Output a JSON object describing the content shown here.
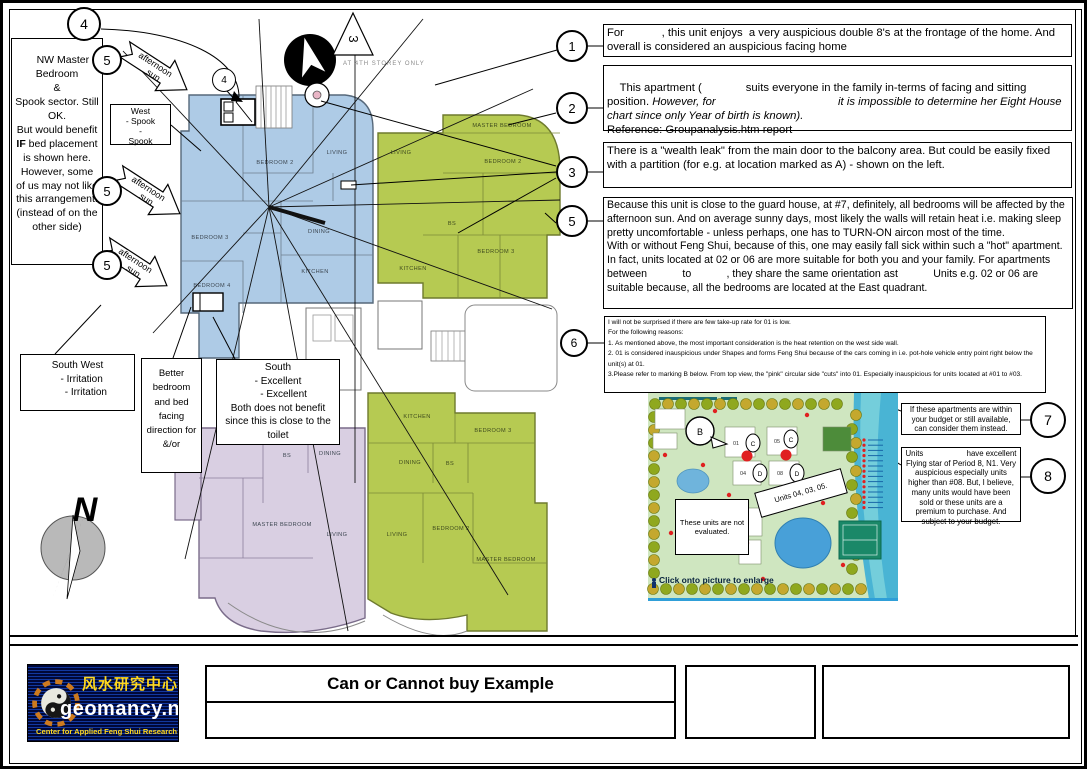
{
  "markers": {
    "n1": "1",
    "n2": "2",
    "n3": "3",
    "n4": "4",
    "n5": "5",
    "n6": "6",
    "n7": "7",
    "n8": "8"
  },
  "left": {
    "nw_part1": "NW Master Bedroom\n&\nSpook sector. Still OK.\nBut would benefit ",
    "nw_bold": "IF",
    "nw_part2": " bed placement is shown here. However, some of us may not like this arrangement.\n(instead of on the other side)",
    "west_box": "West\n- Spook\n-\nSpook",
    "sun_line1": "afternoon",
    "sun_line2": "sun",
    "southwest_box": "South West\n   - Irritation\n      - Irritation",
    "better_box": "Better bedroom and bed facing direction for &/or",
    "south_box": "South\n- Excellent\n    - Excellent\nBoth does not benefit since this is close to the toilet",
    "compass_n": "N"
  },
  "notes": {
    "note1": "For            , this unit enjoys  a very auspicious double 8's at the frontage of the home. And overall is considered an auspicious facing home",
    "note2_normal1": "This apartment (              suits everyone in the family in-terms of facing and sitting position. ",
    "note2_italic": "However, for                                       it is impossible to determine her Eight House chart since only Year of birth is known).",
    "note2_normal2": "\nReference: Groupanalysis.htm report",
    "note3": "There is a \"wealth leak\" from the main door to the balcony area. But could be easily fixed with a partition (for e.g. at location marked as A) - shown on the left.",
    "note4": "Because this unit is close to the guard house, at #7, definitely, all bedrooms will be affected by the afternoon sun. And on average sunny days, most likely the walls will retain heat i.e. making sleep pretty uncomfortable - unless perhaps, one has to TURN-ON aircon most of the time.\nWith or without Feng Shui, because of this, one may easily fall sick within such a \"hot\" apartment.\nIn fact, units located at 02 or 06 are more suitable for both you and your family. For apartments between            to            , they share the same orientation ast            Units e.g. 02 or 06 are suitable because, all the bedrooms are located at the East quadrant.",
    "note6": "I will not be surprised if there are few take-up rate for 01 is low.\nFor the following reasons:\n1. As mentioned above, the most important consideration is the heat retention on the west side wall.\n2. 01 is considered inauspicious under Shapes and forms Feng Shui because of the cars coming in i.e. pot-hole vehicle entry point right below the unit(s) at 01.\n3.Please refer to marking B below. From top view, the \"pink\" circular side \"cuts\" into 01. Especially inauspicious for units located at #01 to #03.",
    "note7": "If these apartments are within your budget or still available, can consider them instead.",
    "note8": "Units                    have excellent Flying star of Period 8, N1. Very auspicious especially units higher than #08. But, I believe, many units would have been sold or these units are a premium to purchase. And subject to your budget."
  },
  "plan": {
    "living": "LIVING",
    "dining": "DINING",
    "kitchen": "KITCHEN",
    "bedroom2": "BEDROOM 2",
    "bedroom3": "BEDROOM 3",
    "bedroom4": "BEDROOM 4",
    "master_bedroom": "MASTER BEDROOM",
    "bs": "BS",
    "storey_note": "AT 4TH STOREY ONLY",
    "triangle_label": "3"
  },
  "map": {
    "not_evaluated": "These units are not evaluated.",
    "rotated_label": "Units 04, 03, 05.",
    "b_marker": "B",
    "caption": "Click onto picture to enlarge",
    "block_01": "01",
    "block_05": "05",
    "block_04": "04",
    "block_08": "08",
    "oval_c": "C",
    "oval_d": "D"
  },
  "footer": {
    "title": "Can or Cannot buy Example",
    "logo_brand": "geomancy.net",
    "logo_chinese": "风水研究中心",
    "logo_tagline": "Center for Applied Feng Shui Research"
  },
  "colors": {
    "unit_blue": "#aecbe6",
    "unit_green": "#b6ca52",
    "unit_lavender": "#d9cfe2",
    "map_accent": "#2f9fd8"
  }
}
